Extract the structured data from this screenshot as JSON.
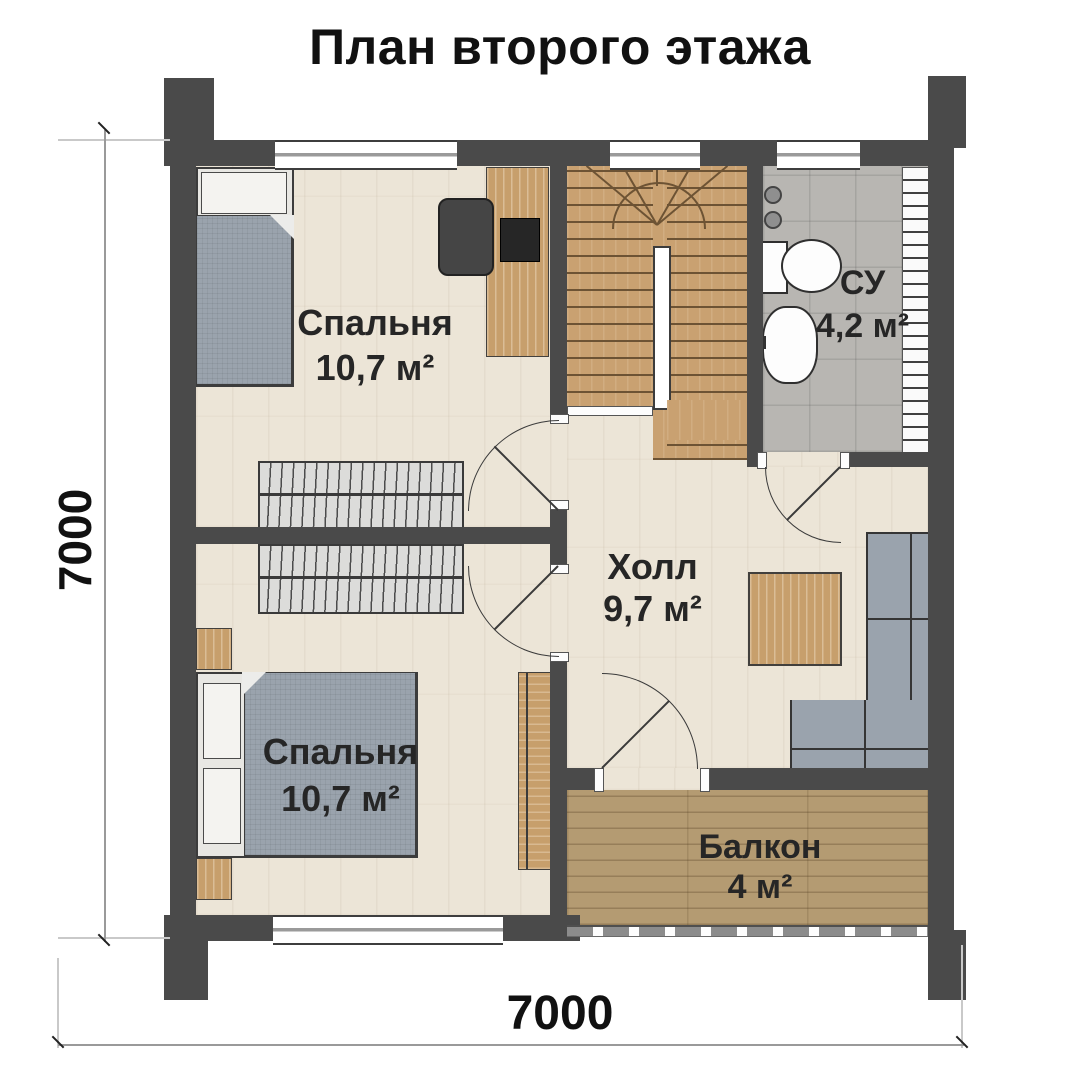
{
  "title": "План второго этажа",
  "rooms": {
    "bedroom_top": {
      "name": "Спальня",
      "area": "10,7 м²"
    },
    "bathroom": {
      "name": "СУ",
      "area": "4,2 м²"
    },
    "hall": {
      "name": "Холл",
      "area": "9,7 м²"
    },
    "bedroom_bottom": {
      "name": "Спальня",
      "area": "10,7 м²"
    },
    "balcony": {
      "name": "Балкон",
      "area": "4 м²"
    }
  },
  "dimensions": {
    "left": "7000",
    "bottom": "7000"
  },
  "colors": {
    "wall": "#4a4a4a",
    "floor_light": "#ece5d7",
    "bathroom_tile": "#b8b6b2",
    "balcony_wood": "#b49b72",
    "stairs_wood": "#c9a171",
    "furniture_wood": "#c79f6c",
    "textile_gray": "#9aa3ad",
    "wardrobe_gray": "#dcdcda",
    "label_text": "#262626",
    "dimension_text": "#111111"
  }
}
